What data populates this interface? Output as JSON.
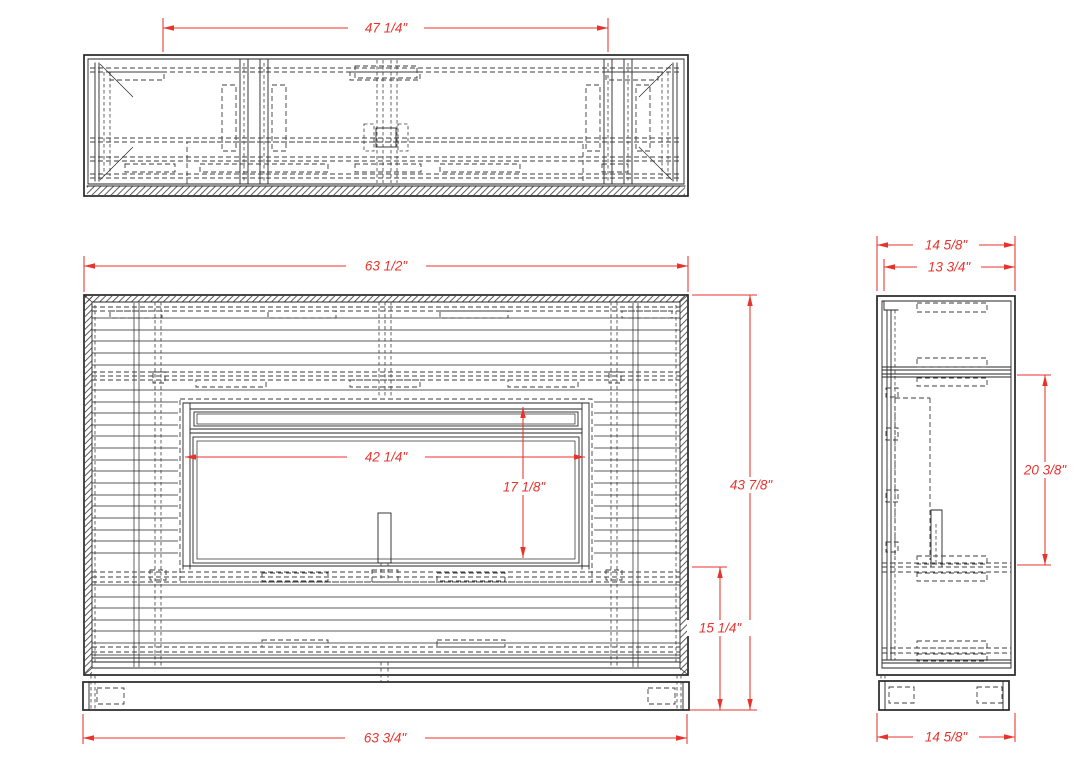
{
  "drawing": {
    "title": "Electric fireplace media console shop drawing",
    "views": {
      "top": {
        "label": "top view"
      },
      "front": {
        "label": "front view"
      },
      "side": {
        "label": "side view"
      }
    }
  },
  "colors": {
    "dim": "#e8332d",
    "line": "#262626",
    "bg": "#ffffff"
  },
  "dims": {
    "top_opening_width": "47 1/4\"",
    "front_width": "63 1/2\"",
    "base_width": "63 3/4\"",
    "insert_width": "42 1/4\"",
    "insert_height": "17 1/8\"",
    "overall_height": "43 7/8\"",
    "hearth_height": "15 1/4\"",
    "depth_top": "14 5/8\"",
    "inner_depth": "13 3/4\"",
    "side_upper_height": "20 3/8\"",
    "depth_bottom": "14 5/8\""
  }
}
